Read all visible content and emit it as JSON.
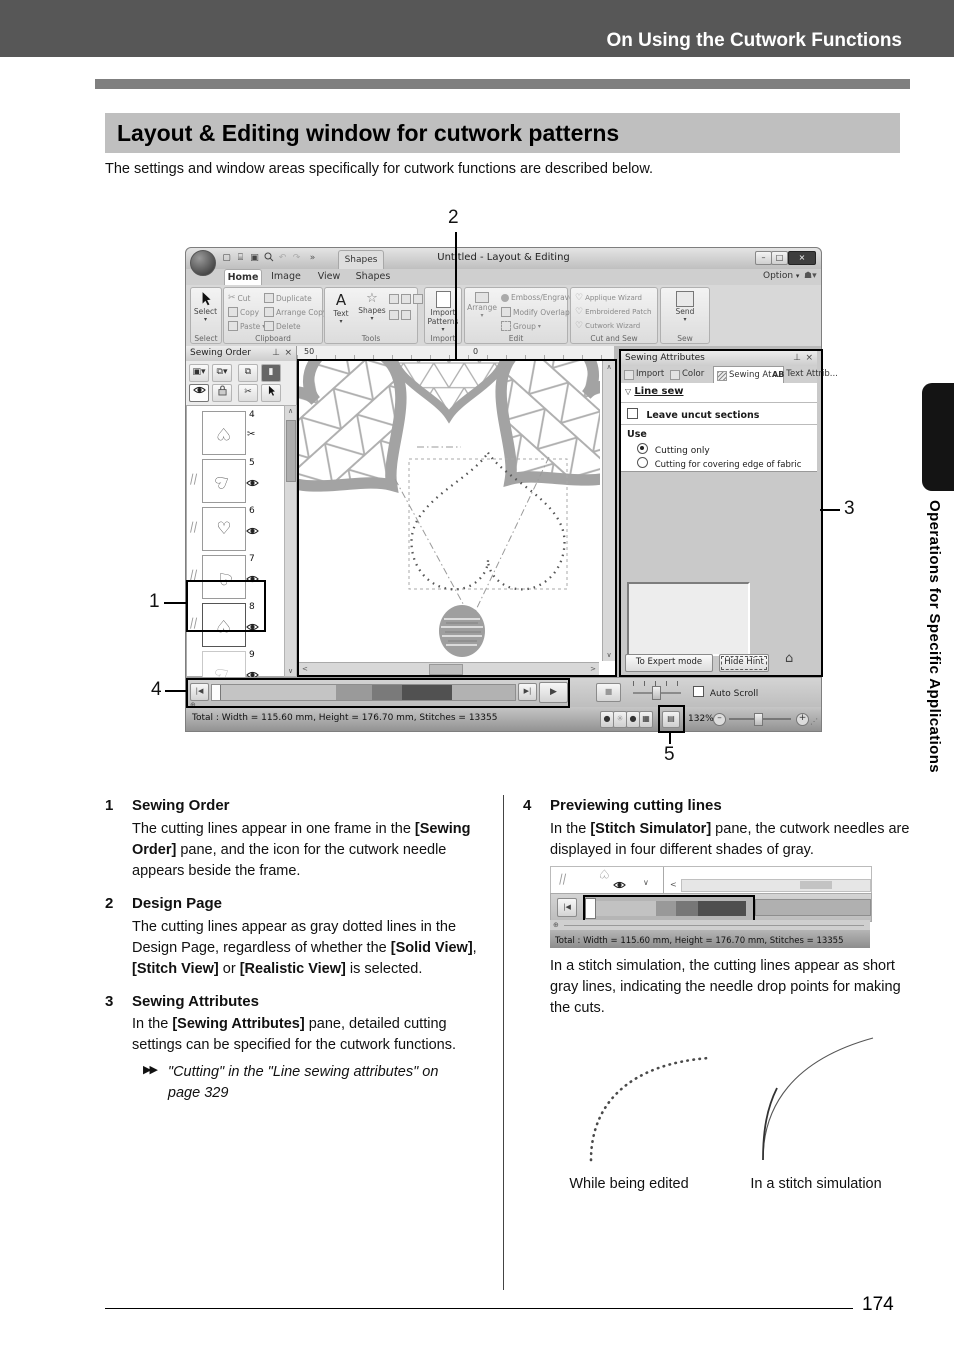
{
  "doc": {
    "header": "On Using the Cutwork Functions",
    "title": "Layout & Editing window for cutwork patterns",
    "intro": "The settings and window areas specifically for cutwork functions are described below.",
    "page_number": "174",
    "side_tab_text": "Operations for Specific Applications"
  },
  "callouts": {
    "n1": "1",
    "n2": "2",
    "n3": "3",
    "n4": "4",
    "n5": "5"
  },
  "win": {
    "title": "Untitled - Layout & Editing",
    "contextual_group": "Shapes",
    "option": "Option",
    "tab_home": "Home",
    "tab_image": "Image",
    "tab_view": "View",
    "tab_shapes": "Shapes",
    "ribbon": {
      "select_btn": "Select",
      "select_lbl": "Select",
      "cut": "Cut",
      "copy": "Copy",
      "paste": "Paste",
      "duplicate": "Duplicate",
      "arrange_copy": "Arrange Copy",
      "delete": "Delete",
      "clipboard_lbl": "Clipboard",
      "text_btn": "Text",
      "shapes_btn": "Shapes",
      "tools_lbl": "Tools",
      "import_btn": "Import Patterns",
      "import_lbl": "Import",
      "arrange_btn": "Arrange",
      "emboss": "Emboss/Engrave",
      "modify": "Modify Overlap",
      "group": "Group",
      "edit_lbl": "Edit",
      "applique": "Applique Wizard",
      "patch": "Embroidered Patch",
      "cutwork": "Cutwork Wizard",
      "cutsew_lbl": "Cut and Sew",
      "send_btn": "Send",
      "sew_lbl": "Sew"
    },
    "order_pane": {
      "title": "Sewing Order",
      "f4": "4",
      "f5": "5",
      "f6": "6",
      "f7": "7",
      "f8": "8",
      "f9": "9"
    },
    "ruler50": "50",
    "ruler0": "0",
    "attr_pane": {
      "title": "Sewing Attributes",
      "tab_import": "Import",
      "tab_color": "Color",
      "tab_sewing": "Sewing At...",
      "tab_text_ab": "AB",
      "tab_text": "Text Attrib...",
      "line_sew": "Line sew",
      "leave_uncut": "Leave uncut sections",
      "use": "Use",
      "cutting_only": "Cutting only",
      "cutting_covering": "Cutting for covering edge of fabric",
      "expert": "To Expert mode",
      "hide_hint": "Hide Hint"
    },
    "auto_scroll": "Auto Scroll",
    "status_total": "Total : Width = 115.60 mm, Height = 176.70 mm, Stitches = 13355",
    "zoom_pct": "132%"
  },
  "items": {
    "i1": {
      "n": "1",
      "t": "Sewing Order",
      "p1": "The cutting lines appear in one frame in the ",
      "b1": "[Sewing Order]",
      "p2": " pane, and the icon for the cutwork needle appears beside the frame."
    },
    "i2": {
      "n": "2",
      "t": "Design Page",
      "p1": "The cutting lines appear as gray dotted lines in the Design Page, regardless of whether the ",
      "b1": "[Solid View]",
      "p2": ", ",
      "b2": "[Stitch View]",
      "p3": " or ",
      "b3": "[Realistic View]",
      "p4": " is selected."
    },
    "i3": {
      "n": "3",
      "t": "Sewing Attributes",
      "p1": "In the ",
      "b1": "[Sewing Attributes]",
      "p2": " pane, detailed cutting settings can be specified for the cutwork functions.",
      "ref": "\"Cutting\" in the \"Line sewing attributes\" on page 329"
    },
    "i4": {
      "n": "4",
      "t": "Previewing cutting lines",
      "p1": "In the ",
      "b1": "[Stitch Simulator]",
      "p2": " pane, the cutwork needles are displayed in four different shades of gray.",
      "p3": "In a stitch simulation, the cutting lines appear as short gray lines, indicating the needle drop points for making the cuts.",
      "cap1": "While being edited",
      "cap2": "In a stitch simulation"
    }
  },
  "colors": {
    "header_band": "#575757",
    "title_block": "#bfbfbf",
    "callout_box": "#000000"
  }
}
